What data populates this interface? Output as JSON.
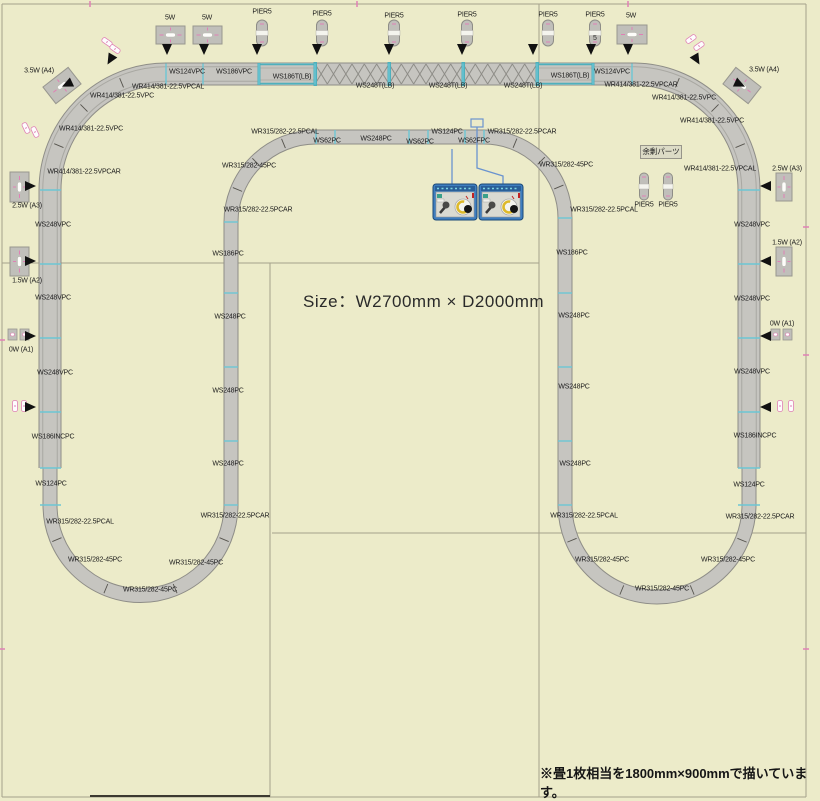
{
  "size_label": "Size：W2700mm × D2000mm",
  "footnote": "※畳1枚相当を1800mm×900mmで描いています。",
  "surplus_parts_label": "余剰パーツ",
  "colors": {
    "background": "#ecebc9",
    "grid": "#a5a28c",
    "grid_dark": "#3c3a30",
    "track_fill": "#c6c5c0",
    "track_edge": "#8e8d87",
    "track_mid": "#a9a8a2",
    "joint_tick": "#6cc6d4",
    "bridge_teal": "#4fb0bc",
    "pink": "#e080b5",
    "label": "#1c1c1c",
    "arrow": "#111111",
    "wire": "#6a93cf",
    "controller_body": "#3f7ec0",
    "controller_face": "#dadad2"
  },
  "labels": [
    {
      "t": "5W",
      "x": 170,
      "y": 17
    },
    {
      "t": "5W",
      "x": 207,
      "y": 17
    },
    {
      "t": "5W",
      "x": 631,
      "y": 15
    },
    {
      "t": "PIER5",
      "x": 262,
      "y": 11
    },
    {
      "t": "PIER5",
      "x": 322,
      "y": 13
    },
    {
      "t": "PIER5",
      "x": 394,
      "y": 15
    },
    {
      "t": "PIER5",
      "x": 467,
      "y": 14
    },
    {
      "t": "PIER5",
      "x": 548,
      "y": 14
    },
    {
      "t": "PIER5",
      "x": 595,
      "y": 14
    },
    {
      "t": "3.5W (A4)",
      "x": 39,
      "y": 70
    },
    {
      "t": "3.5W (A4)",
      "x": 764,
      "y": 69
    },
    {
      "t": "WS124VPC",
      "x": 187,
      "y": 71
    },
    {
      "t": "WS186VPC",
      "x": 234,
      "y": 71
    },
    {
      "t": "WS186T(LB)",
      "x": 292,
      "y": 76
    },
    {
      "t": "WS248T(LB)",
      "x": 375,
      "y": 85
    },
    {
      "t": "WS248T(LB)",
      "x": 448,
      "y": 85
    },
    {
      "t": "WS248T(LB)",
      "x": 523,
      "y": 85
    },
    {
      "t": "WS186T(LB)",
      "x": 570,
      "y": 75
    },
    {
      "t": "WS124VPC",
      "x": 612,
      "y": 71
    },
    {
      "t": "WR414/381-22.5VPCAL",
      "x": 168,
      "y": 86
    },
    {
      "t": "WR414/381-22.5VPC",
      "x": 122,
      "y": 95
    },
    {
      "t": "WR414/381-22.5VPC",
      "x": 91,
      "y": 128
    },
    {
      "t": "WR414/381-22.5VPCAR",
      "x": 84,
      "y": 171
    },
    {
      "t": "WR414/381-22.5VPCAR",
      "x": 641,
      "y": 84
    },
    {
      "t": "WR414/381-22.5VPC",
      "x": 684,
      "y": 97
    },
    {
      "t": "WR414/381-22.5VPC",
      "x": 712,
      "y": 120
    },
    {
      "t": "WR414/381-22.5VPCAL",
      "x": 720,
      "y": 168
    },
    {
      "t": "2.5W (A3)",
      "x": 27,
      "y": 205
    },
    {
      "t": "WS248VPC",
      "x": 53,
      "y": 224
    },
    {
      "t": "1.5W (A2)",
      "x": 27,
      "y": 280
    },
    {
      "t": "WS248VPC",
      "x": 53,
      "y": 297
    },
    {
      "t": "0W (A1)",
      "x": 21,
      "y": 349
    },
    {
      "t": "WS248VPC",
      "x": 55,
      "y": 372
    },
    {
      "t": "WS186INCPC",
      "x": 53,
      "y": 436
    },
    {
      "t": "WS124PC",
      "x": 51,
      "y": 483
    },
    {
      "t": "WR315/282-22.5PCAL",
      "x": 80,
      "y": 521
    },
    {
      "t": "WR315/282-45PC",
      "x": 95,
      "y": 559
    },
    {
      "t": "WR315/282-45PC",
      "x": 150,
      "y": 589
    },
    {
      "t": "WR315/282-45PC",
      "x": 196,
      "y": 562
    },
    {
      "t": "WR315/282-22.5PCAR",
      "x": 235,
      "y": 515
    },
    {
      "t": "WR315/282-45PC",
      "x": 249,
      "y": 165
    },
    {
      "t": "WR315/282-22.5PCAR",
      "x": 258,
      "y": 209
    },
    {
      "t": "WS186PC",
      "x": 228,
      "y": 253
    },
    {
      "t": "WS248PC",
      "x": 230,
      "y": 316
    },
    {
      "t": "WS248PC",
      "x": 228,
      "y": 390
    },
    {
      "t": "WS248PC",
      "x": 228,
      "y": 463
    },
    {
      "t": "WR315/282-22.5PCAL",
      "x": 285,
      "y": 131
    },
    {
      "t": "WS62PC",
      "x": 327,
      "y": 140
    },
    {
      "t": "WS248PC",
      "x": 376,
      "y": 138
    },
    {
      "t": "WS62PC",
      "x": 420,
      "y": 141
    },
    {
      "t": "WS124PC",
      "x": 447,
      "y": 131
    },
    {
      "t": "WS62FPC",
      "x": 474,
      "y": 140
    },
    {
      "t": "WR315/282-22.5PCAR",
      "x": 522,
      "y": 131
    },
    {
      "t": "WR315/282-45PC",
      "x": 566,
      "y": 164
    },
    {
      "t": "WR315/282-22.5PCAL",
      "x": 604,
      "y": 209
    },
    {
      "t": "WS186PC",
      "x": 572,
      "y": 252
    },
    {
      "t": "WS248PC",
      "x": 574,
      "y": 315
    },
    {
      "t": "WS248PC",
      "x": 574,
      "y": 386
    },
    {
      "t": "WS248PC",
      "x": 575,
      "y": 463
    },
    {
      "t": "WR315/282-22.5PCAL",
      "x": 584,
      "y": 515
    },
    {
      "t": "WR315/282-45PC",
      "x": 602,
      "y": 559
    },
    {
      "t": "WR315/282-45PC",
      "x": 662,
      "y": 588
    },
    {
      "t": "WR315/282-45PC",
      "x": 728,
      "y": 559
    },
    {
      "t": "WR315/282-22.5PCAR",
      "x": 760,
      "y": 516
    },
    {
      "t": "WS124PC",
      "x": 749,
      "y": 484
    },
    {
      "t": "WS248VPC",
      "x": 752,
      "y": 224
    },
    {
      "t": "2.5W (A3)",
      "x": 787,
      "y": 168
    },
    {
      "t": "1.5W (A2)",
      "x": 787,
      "y": 242
    },
    {
      "t": "WS248VPC",
      "x": 752,
      "y": 298
    },
    {
      "t": "0W (A1)",
      "x": 782,
      "y": 323
    },
    {
      "t": "WS248VPC",
      "x": 752,
      "y": 371
    },
    {
      "t": "WS186INCPC",
      "x": 755,
      "y": 435
    },
    {
      "t": "PIER5",
      "x": 644,
      "y": 204
    },
    {
      "t": "PIER5",
      "x": 668,
      "y": 204
    }
  ],
  "geometry": {
    "loop": "M632,74 L166,74 A116,116 0 0 0 50,190 L50,505 A90.5,90.5 0 0 0 231,505 L231,222 A85,85 0 0 1 316,137 L484,137 A81,81 0 0 1 565,218 L565,505 A92,92 0 0 0 749,505 L749,190 A116,116 0 0 0 633,74 Z",
    "viaduct": "M50,468 L50,190 A116,116 0 0 1 166,74 L632,74 A116,116 0 0 1 749,190 L749,468",
    "girder_bridges": [
      [
        259,
        315
      ],
      [
        537,
        593
      ]
    ],
    "truss_bridges": [
      [
        315,
        389
      ],
      [
        389,
        463
      ],
      [
        463,
        537
      ]
    ],
    "joints_top_x": [
      166,
      203,
      259,
      315,
      389,
      463,
      537,
      593,
      632
    ],
    "joints_inner_x": [
      316,
      335,
      409,
      428,
      465,
      484
    ],
    "joints_left_y": [
      190,
      264,
      338,
      412,
      468,
      505
    ],
    "joints_right_y": [
      190,
      264,
      338,
      412,
      468,
      505
    ],
    "joints_innerleft_y": [
      222,
      293,
      367,
      441,
      505
    ],
    "joints_innerright_y": [
      218,
      293,
      367,
      441,
      505
    ],
    "curve_ticks": [
      {
        "cx": 140.5,
        "cy": 505,
        "r": 90.5,
        "angles": [
          157.5,
          112.5,
          67.5,
          22.5
        ]
      },
      {
        "cx": 657,
        "cy": 505,
        "r": 92,
        "angles": [
          157.5,
          112.5,
          67.5,
          22.5
        ]
      },
      {
        "cx": 166,
        "cy": 190,
        "r": 116,
        "angles": [
          202.5,
          225,
          247.5
        ]
      },
      {
        "cx": 633,
        "cy": 190,
        "r": 116,
        "angles": [
          292.5,
          315,
          337.5
        ]
      },
      {
        "cx": 316,
        "cy": 222,
        "r": 85,
        "angles": [
          202.5,
          225,
          247.5
        ]
      },
      {
        "cx": 484,
        "cy": 218,
        "r": 81,
        "angles": [
          292.5,
          315,
          337.5
        ]
      }
    ]
  },
  "grid_lines": [
    {
      "x1": 2,
      "y1": 4,
      "x2": 806,
      "y2": 4
    },
    {
      "x1": 2,
      "y1": 797,
      "x2": 806,
      "y2": 797
    },
    {
      "x1": 2,
      "y1": 4,
      "x2": 2,
      "y2": 797
    },
    {
      "x1": 806,
      "y1": 4,
      "x2": 806,
      "y2": 797
    },
    {
      "x1": 270,
      "y1": 263,
      "x2": 270,
      "y2": 797
    },
    {
      "x1": 539,
      "y1": 4,
      "x2": 539,
      "y2": 797
    },
    {
      "x1": 2,
      "y1": 263,
      "x2": 539,
      "y2": 263
    },
    {
      "x1": 272,
      "y1": 533,
      "x2": 806,
      "y2": 533
    },
    {
      "x1": 90,
      "y1": 796,
      "x2": 270,
      "y2": 796,
      "dark": true
    }
  ],
  "pink_ticks": [
    {
      "x": 90,
      "y": 4,
      "o": "v"
    },
    {
      "x": 357,
      "y": 4,
      "o": "v"
    },
    {
      "x": 628,
      "y": 4,
      "o": "v"
    },
    {
      "x": 806,
      "y": 227,
      "o": "h"
    },
    {
      "x": 806,
      "y": 355,
      "o": "h"
    },
    {
      "x": 806,
      "y": 649,
      "o": "h"
    },
    {
      "x": 2,
      "y": 340,
      "o": "h"
    },
    {
      "x": 2,
      "y": 649,
      "o": "h"
    }
  ],
  "piers": [
    {
      "x": 262,
      "y": 20
    },
    {
      "x": 322,
      "y": 20
    },
    {
      "x": 394,
      "y": 20
    },
    {
      "x": 467,
      "y": 20
    },
    {
      "x": 548,
      "y": 20
    },
    {
      "x": 595,
      "y": 20,
      "inner": "5"
    },
    {
      "x": 644,
      "y": 173,
      "small": true
    },
    {
      "x": 668,
      "y": 173,
      "small": true
    }
  ],
  "boxes": [
    {
      "x": 156,
      "y": 26,
      "w": 29,
      "h": 18
    },
    {
      "x": 193,
      "y": 26,
      "w": 29,
      "h": 18
    },
    {
      "x": 617,
      "y": 25,
      "w": 30,
      "h": 19
    },
    {
      "x": 46,
      "y": 75,
      "w": 32,
      "h": 21,
      "rot": -38
    },
    {
      "x": 726,
      "y": 75,
      "w": 32,
      "h": 21,
      "rot": 38
    },
    {
      "x": 10,
      "y": 172,
      "w": 19,
      "h": 30
    },
    {
      "x": 776,
      "y": 173,
      "w": 16,
      "h": 28
    },
    {
      "x": 10,
      "y": 247,
      "w": 19,
      "h": 29
    },
    {
      "x": 776,
      "y": 247,
      "w": 16,
      "h": 29
    },
    {
      "x": 8,
      "y": 329,
      "w": 21,
      "h": 11,
      "pair": true
    },
    {
      "x": 771,
      "y": 329,
      "w": 21,
      "h": 11,
      "pair": true
    }
  ],
  "arrows": [
    {
      "x": 167,
      "y": 44,
      "r": 90
    },
    {
      "x": 204,
      "y": 44,
      "r": 90
    },
    {
      "x": 257,
      "y": 44,
      "r": 90
    },
    {
      "x": 317,
      "y": 44,
      "r": 90
    },
    {
      "x": 389,
      "y": 44,
      "r": 90
    },
    {
      "x": 462,
      "y": 44,
      "r": 90
    },
    {
      "x": 533,
      "y": 44,
      "r": 90
    },
    {
      "x": 591,
      "y": 44,
      "r": 90
    },
    {
      "x": 628,
      "y": 44,
      "r": 90
    },
    {
      "x": 113,
      "y": 55,
      "r": 120
    },
    {
      "x": 72,
      "y": 82,
      "r": 155
    },
    {
      "x": 694,
      "y": 55,
      "r": 60
    },
    {
      "x": 735,
      "y": 82,
      "r": 25
    },
    {
      "x": 25,
      "y": 186,
      "r": 0
    },
    {
      "x": 25,
      "y": 261,
      "r": 0
    },
    {
      "x": 25,
      "y": 336,
      "r": 0
    },
    {
      "x": 25,
      "y": 407,
      "r": 0
    },
    {
      "x": 771,
      "y": 186,
      "r": 180
    },
    {
      "x": 771,
      "y": 261,
      "r": 180
    },
    {
      "x": 771,
      "y": 336,
      "r": 180
    },
    {
      "x": 771,
      "y": 407,
      "r": 180
    }
  ],
  "mini_pieces": [
    {
      "x": 107,
      "y": 42,
      "r": -55
    },
    {
      "x": 115,
      "y": 49,
      "r": -55
    },
    {
      "x": 691,
      "y": 39,
      "r": 55
    },
    {
      "x": 699,
      "y": 46,
      "r": 55
    },
    {
      "x": 26,
      "y": 128,
      "r": -25
    },
    {
      "x": 35,
      "y": 132,
      "r": -25
    },
    {
      "x": 15,
      "y": 406,
      "r": 0
    },
    {
      "x": 24,
      "y": 406,
      "r": 0
    },
    {
      "x": 780,
      "y": 406,
      "r": 0
    },
    {
      "x": 791,
      "y": 406,
      "r": 0
    }
  ],
  "feeder": {
    "box": {
      "x": 471,
      "y": 119,
      "w": 12,
      "h": 8
    },
    "wires": [
      "M452,149 L452,184",
      "M477,127 L477,168 L503,176 L503,184"
    ]
  },
  "controllers": [
    {
      "x": 433,
      "y": 184
    },
    {
      "x": 479,
      "y": 184
    }
  ]
}
